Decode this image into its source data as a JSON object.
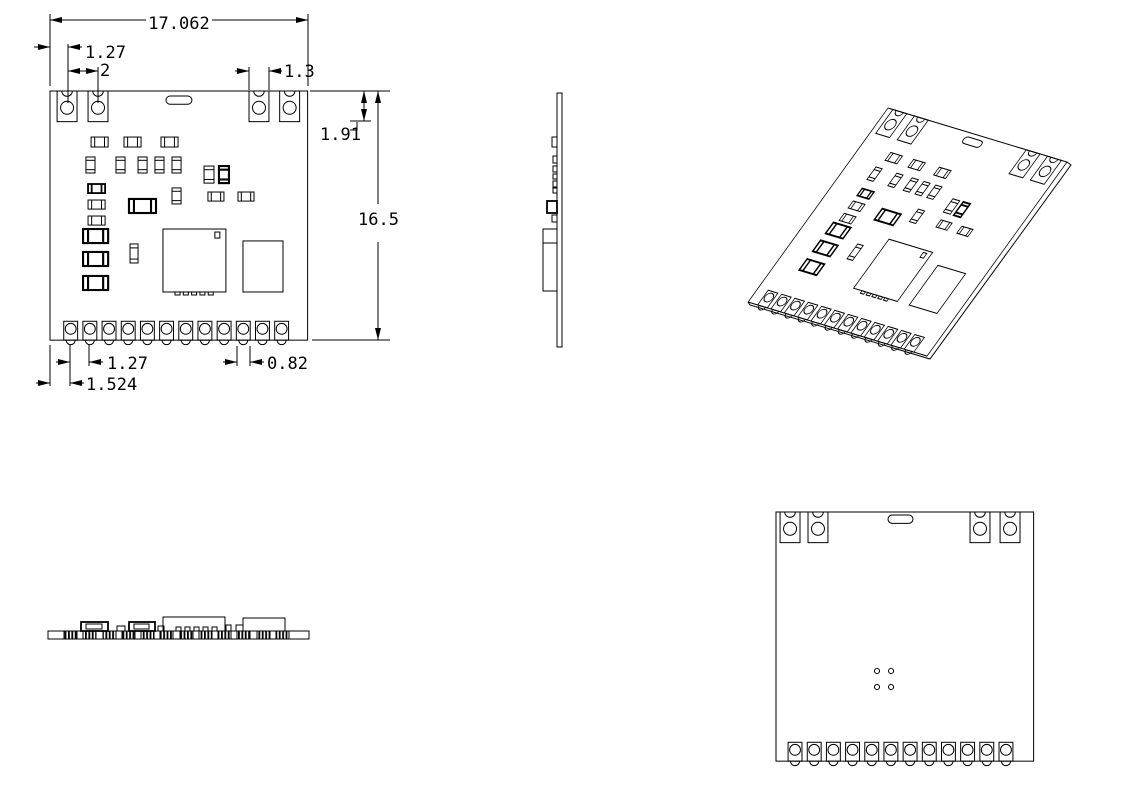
{
  "drawing": {
    "type": "mechanical-drawing-pcb-module",
    "colors": {
      "line": "#000000",
      "background": "#ffffff"
    },
    "dims": {
      "board_width": "17.062",
      "hole_edge_offset": "1.27",
      "hole_pitch": "2",
      "tab_width": "1.3",
      "tab_depth": "1.91",
      "board_height": "16.5",
      "pad_pitch": "1.27",
      "pad_edge_offset": "1.524",
      "pad_width": "0.82"
    }
  }
}
